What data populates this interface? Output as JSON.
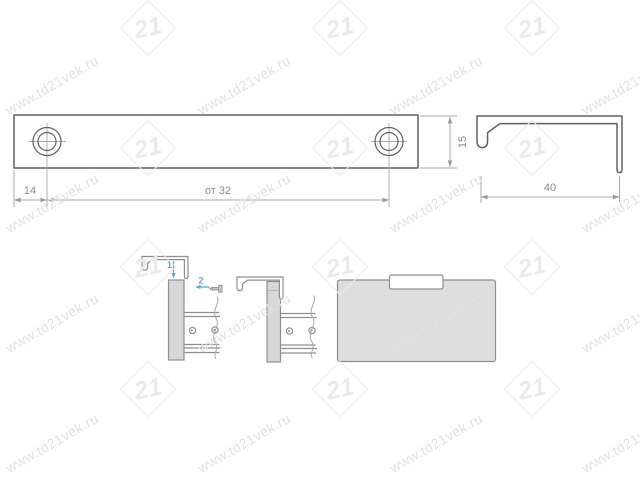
{
  "watermark": {
    "text": "www.td21vek.ru",
    "logo_text": "21"
  },
  "colors": {
    "background": "#ffffff",
    "outline": "#606060",
    "thin": "#a9a9a9",
    "dim_arrow": "#9a9a9a",
    "dim_text": "#8c8c8c",
    "hidden": "#b8b8b8",
    "part_fill": "#ffffff",
    "panel_fill": "#d7d7d7",
    "panel_stroke": "#8f8f8f",
    "facade_fill": "#dedede",
    "tab_fill": "#ffffff",
    "accent_blue": "#58a8d8",
    "watermark_text": "#e2e2e2",
    "watermark_logo": "#ebebeb"
  },
  "front_view": {
    "dim_left": "14",
    "dim_span": "от 32",
    "dim_height": "15"
  },
  "side_view": {
    "dim_width": "40"
  },
  "assembly": {
    "step1": "1",
    "step2": "2"
  }
}
